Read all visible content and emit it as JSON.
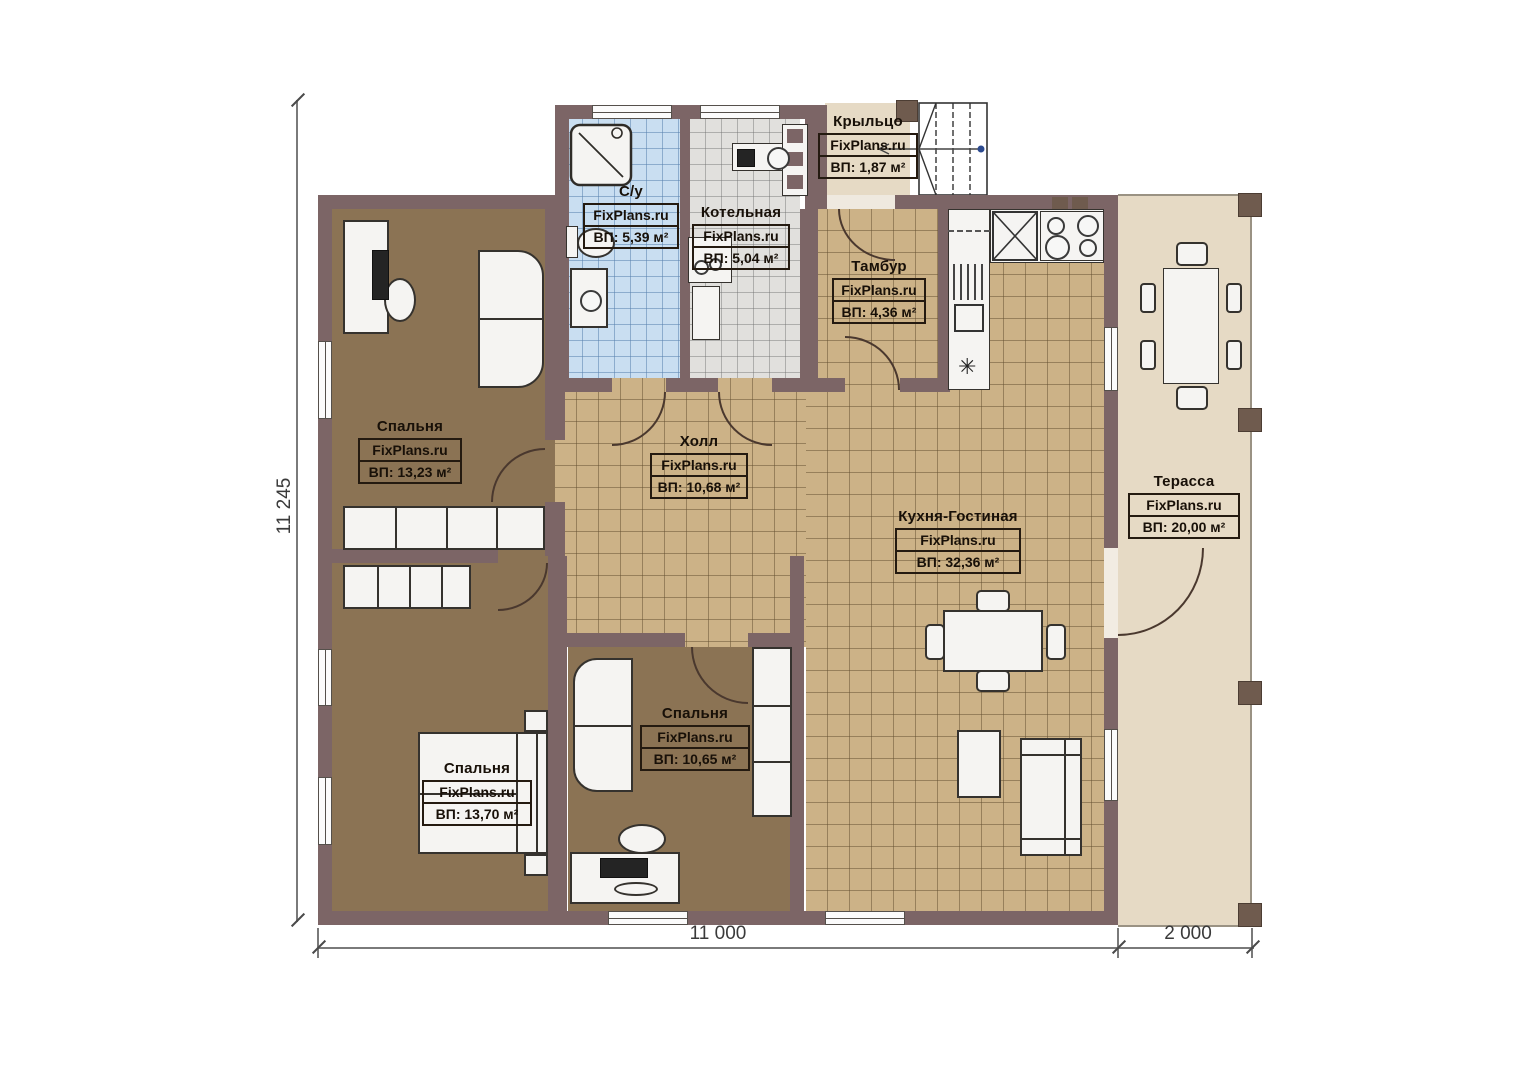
{
  "brand": "FixPlans.ru",
  "plan": {
    "type": "single-storey house floor plan",
    "language": "ru"
  },
  "dimensions": {
    "left": "11 245",
    "bottom_main": "11 000",
    "bottom_terrace": "2 000"
  },
  "rooms": [
    {
      "id": "porch",
      "name": "Крыльцо",
      "area": "ВП: 1,87 м²"
    },
    {
      "id": "bathroom",
      "name": "С/у",
      "area": "ВП: 5,39 м²"
    },
    {
      "id": "boiler-room",
      "name": "Котельная",
      "area": "ВП: 5,04 м²"
    },
    {
      "id": "vestibule",
      "name": "Тамбур",
      "area": "ВП: 4,36 м²"
    },
    {
      "id": "bedroom-1",
      "name": "Спальня",
      "area": "ВП: 13,23 м²"
    },
    {
      "id": "hall",
      "name": "Холл",
      "area": "ВП: 10,68 м²"
    },
    {
      "id": "kitchen-living",
      "name": "Кухня-Гостиная",
      "area": "ВП: 32,36 м²"
    },
    {
      "id": "terrace",
      "name": "Терасса",
      "area": "ВП: 20,00 м²"
    },
    {
      "id": "bedroom-2",
      "name": "Спальня",
      "area": "ВП: 10,65 м²"
    },
    {
      "id": "bedroom-3",
      "name": "Спальня",
      "area": "ВП: 13,70 м²"
    }
  ],
  "colors": {
    "wall": "#7c6566",
    "tile_tan": "#ccb287",
    "carpet_brown": "#8b7354",
    "tile_blue": "#c9def1",
    "tile_gray": "#e1e0dd",
    "deck_beige": "#e6dac5",
    "label_ink": "#241a10"
  }
}
